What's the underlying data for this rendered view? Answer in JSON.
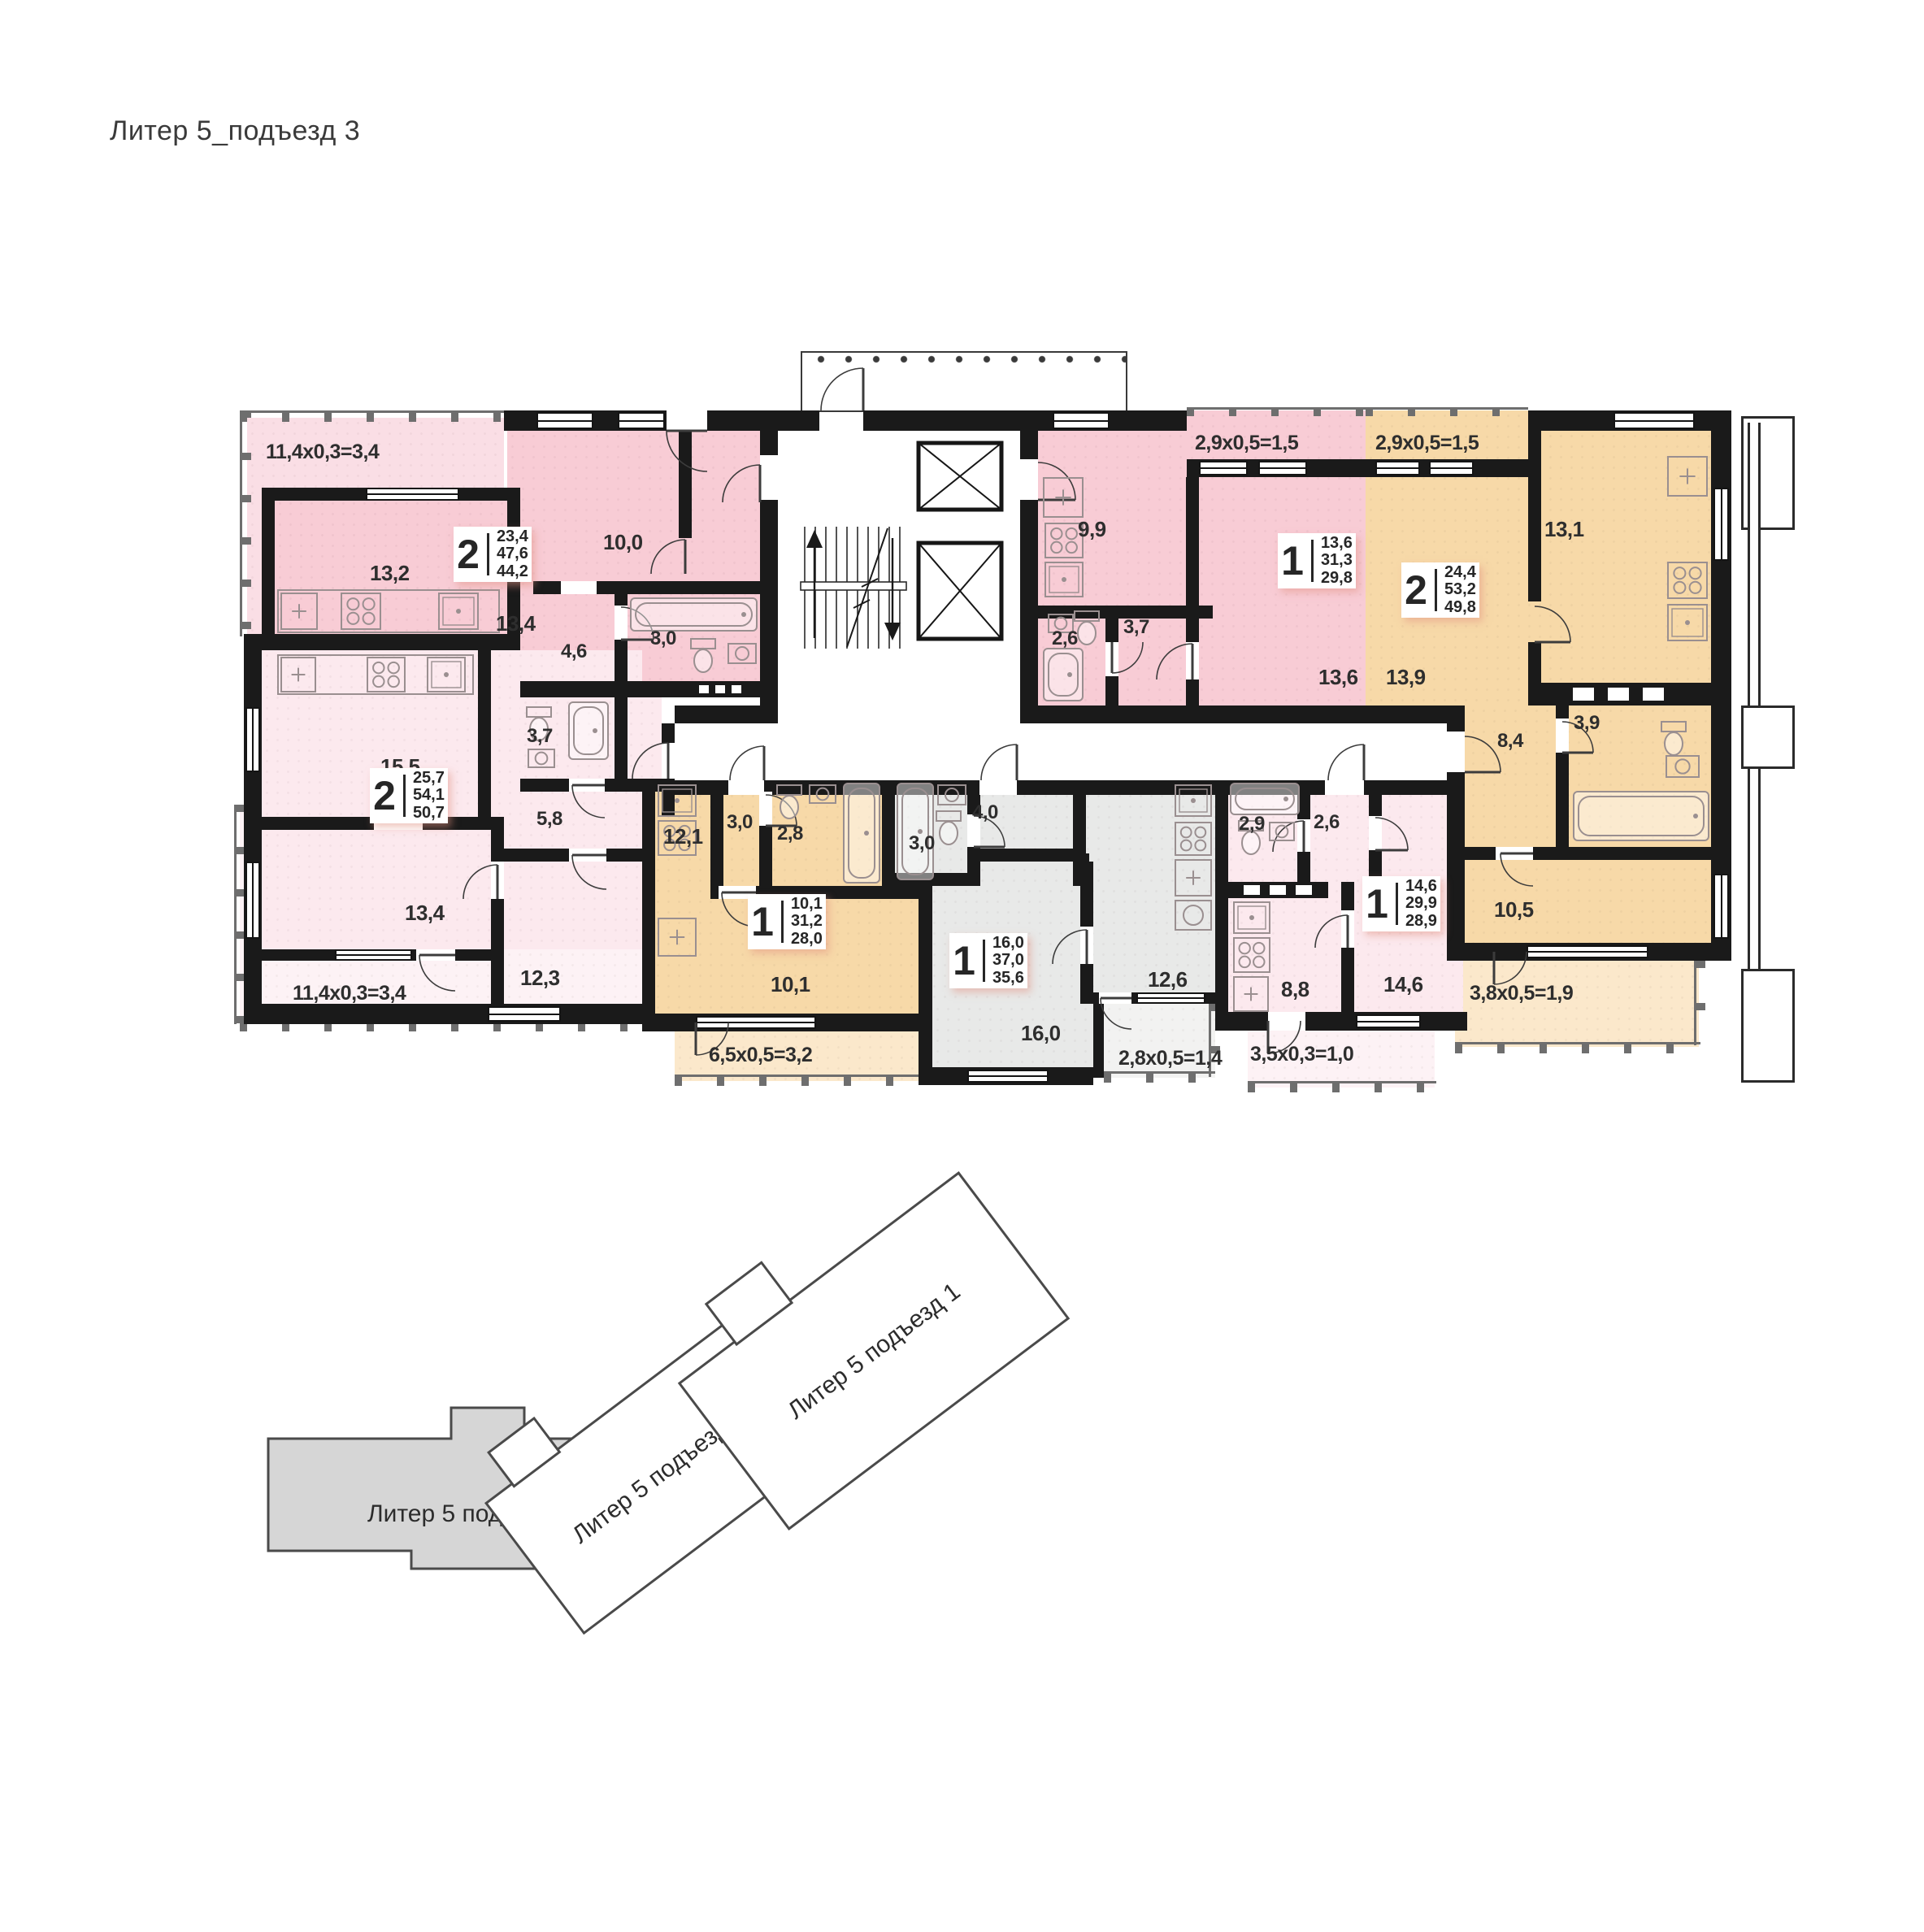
{
  "title": "Литер 5_подъезд 3",
  "plan": {
    "apartments": [
      {
        "id": "top-left",
        "rooms_count": "2",
        "areas": [
          "23,4",
          "47,6",
          "44,2"
        ],
        "balcony": "11,4x0,3=3,4",
        "rooms": [
          {
            "name": "kitchen-living",
            "area": "13,2"
          },
          {
            "name": "hall",
            "area": "13,4"
          },
          {
            "name": "bedroom",
            "area": "10,0"
          },
          {
            "name": "corridor",
            "area": "4,6"
          },
          {
            "name": "bathroom",
            "area": "3,0"
          }
        ]
      },
      {
        "id": "bottom-left",
        "rooms_count": "2",
        "areas": [
          "25,7",
          "54,1",
          "50,7"
        ],
        "balcony": "11,4x0,3=3,4",
        "rooms": [
          {
            "name": "kitchen-living",
            "area": "15,5"
          },
          {
            "name": "bathroom",
            "area": "3,7"
          },
          {
            "name": "hall",
            "area": "5,8"
          },
          {
            "name": "room",
            "area": "13,4"
          },
          {
            "name": "bedroom",
            "area": "12,3"
          }
        ]
      },
      {
        "id": "center-top",
        "rooms_count": "1",
        "areas": [
          "13,6",
          "31,3",
          "29,8"
        ],
        "balcony": "2,9x0,5=1,5",
        "rooms": [
          {
            "name": "kitchen",
            "area": "9,9"
          },
          {
            "name": "bathroom",
            "area": "2,6"
          },
          {
            "name": "hall",
            "area": "3,7"
          },
          {
            "name": "living",
            "area": "13,6"
          }
        ]
      },
      {
        "id": "top-right",
        "rooms_count": "2",
        "areas": [
          "24,4",
          "53,2",
          "49,8"
        ],
        "balcony": "2,9x0,5=1,5",
        "balcony2": "3,8x0,5=1,9",
        "rooms": [
          {
            "name": "living",
            "area": "13,9"
          },
          {
            "name": "kitchen",
            "area": "13,1"
          },
          {
            "name": "bathroom",
            "area": "3,9"
          },
          {
            "name": "hall",
            "area": "8,4"
          },
          {
            "name": "bedroom",
            "area": "10,5"
          }
        ]
      },
      {
        "id": "bottom-center-left",
        "rooms_count": "1",
        "areas": [
          "10,1",
          "31,2",
          "28,0"
        ],
        "balcony": "6,5x0,5=3,2",
        "rooms": [
          {
            "name": "kitchen",
            "area": "12,1"
          },
          {
            "name": "corridor",
            "area": "3,0"
          },
          {
            "name": "bathroom",
            "area": "2,8"
          },
          {
            "name": "living",
            "area": "10,1"
          }
        ]
      },
      {
        "id": "bottom-center-right",
        "rooms_count": "1",
        "areas": [
          "16,0",
          "37,0",
          "35,6"
        ],
        "balcony": "2,8x0,5=1,4",
        "rooms": [
          {
            "name": "bathroom",
            "area": "3,0"
          },
          {
            "name": "corridor",
            "area": "4,0"
          },
          {
            "name": "kitchen",
            "area": "12,6"
          },
          {
            "name": "living",
            "area": "16,0"
          }
        ]
      },
      {
        "id": "bottom-right",
        "rooms_count": "1",
        "areas": [
          "14,6",
          "29,9",
          "28,9"
        ],
        "balcony": "3,5x0,3=1,0",
        "rooms": [
          {
            "name": "bathroom",
            "area": "2,9"
          },
          {
            "name": "hall",
            "area": "2,6"
          },
          {
            "name": "kitchen",
            "area": "8,8"
          },
          {
            "name": "living",
            "area": "14,6"
          }
        ]
      }
    ]
  },
  "key_plan": {
    "sections": [
      {
        "label": "Литер 5 подъезд 3",
        "highlighted": true
      },
      {
        "label": "Литер 5 подъезд 2",
        "highlighted": false
      },
      {
        "label": "Литер 5 подъезд 1",
        "highlighted": false
      }
    ]
  },
  "colors": {
    "wall": "#1a1a1a",
    "apartment_pink": "#f8ccd5",
    "apartment_pink_light": "#fce9ee",
    "apartment_orange": "#f7d9a8",
    "apartment_orange_light": "#fbe8cb",
    "apartment_gray": "#e8e9e8",
    "apartment_gray_light": "#f2f2f1",
    "highlight_gray": "#d6d6d6"
  }
}
